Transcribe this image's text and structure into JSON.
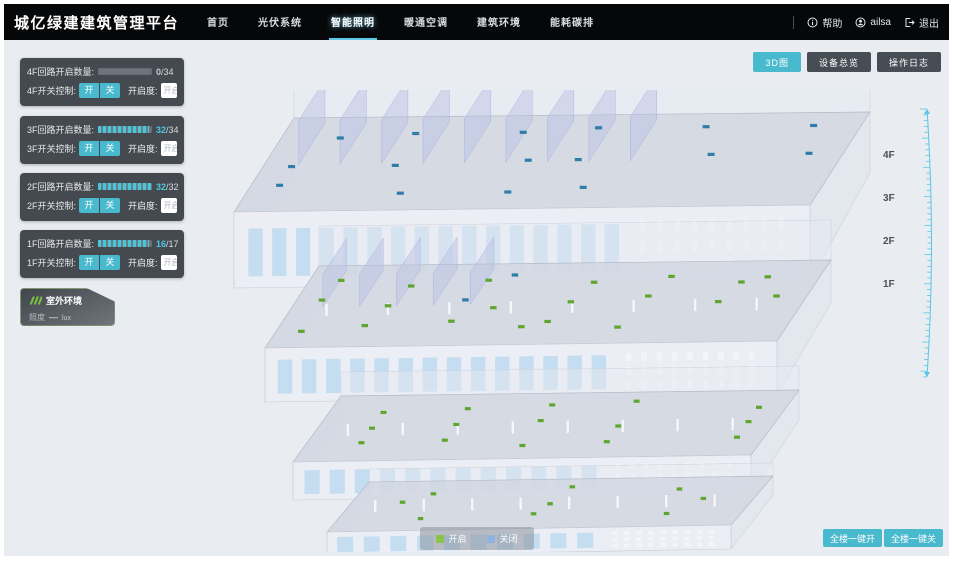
{
  "accent": {
    "teal": "#49b9cd",
    "cyan": "#4cc8e0"
  },
  "header": {
    "title": "城亿绿建建筑管理平台",
    "nav": [
      {
        "label": "首页"
      },
      {
        "label": "光伏系统"
      },
      {
        "label": "智能照明"
      },
      {
        "label": "暖通空调"
      },
      {
        "label": "建筑环境"
      },
      {
        "label": "能耗碳排"
      }
    ],
    "help_label": "帮助",
    "username": "ailsa",
    "logout_label": "退出"
  },
  "view_buttons": [
    {
      "label": "3D图"
    },
    {
      "label": "设备总览"
    },
    {
      "label": "操作日志"
    }
  ],
  "floor_panels": [
    {
      "circuit_label": "4F回路开启数量:",
      "open_count": "0",
      "total_count": "/34",
      "progress_width": "0%",
      "count_color": "#c3c8ce",
      "switch_label": "4F开关控制:",
      "on_label": "开",
      "off_label": "关",
      "dim_label": "开启度:",
      "dim_placeholder": "开启度",
      "percent_label": "%"
    },
    {
      "circuit_label": "3F回路开启数量:",
      "open_count": "32",
      "total_count": "/34",
      "progress_width": "94%",
      "count_color": "#4cc8e0",
      "switch_label": "3F开关控制:",
      "on_label": "开",
      "off_label": "关",
      "dim_label": "开启度:",
      "dim_placeholder": "开启度",
      "percent_label": "%"
    },
    {
      "circuit_label": "2F回路开启数量:",
      "open_count": "32",
      "total_count": "/32",
      "progress_width": "100%",
      "count_color": "#4cc8e0",
      "switch_label": "2F开关控制:",
      "on_label": "开",
      "off_label": "关",
      "dim_label": "开启度:",
      "dim_placeholder": "开启度",
      "percent_label": "%"
    },
    {
      "circuit_label": "1F回路开启数量:",
      "open_count": "16",
      "total_count": "/17",
      "progress_width": "94%",
      "count_color": "#4cc8e0",
      "switch_label": "1F开关控制:",
      "on_label": "开",
      "off_label": "关",
      "dim_label": "开启度:",
      "dim_placeholder": "开启度",
      "percent_label": "%"
    }
  ],
  "outdoor_panel": {
    "title": "室外环境",
    "metric_label": "照度",
    "metric_value": "—",
    "metric_unit": "lux"
  },
  "floor_axis_labels": [
    "4F",
    "3F",
    "2F",
    "1F"
  ],
  "legend": {
    "on_label": "开启",
    "on_color": "#8bc34a",
    "off_label": "关闭",
    "off_color": "#8fb3e0"
  },
  "bulk_buttons": [
    {
      "label": "全楼一键开"
    },
    {
      "label": "全楼一键关"
    }
  ],
  "building": {
    "floors": [
      {
        "name": "4F",
        "on_markers": 0,
        "off_markers": 16
      },
      {
        "name": "3F",
        "on_markers": 20,
        "off_markers": 2
      },
      {
        "name": "2F",
        "on_markers": 15,
        "off_markers": 0
      },
      {
        "name": "1F",
        "on_markers": 9,
        "off_markers": 0
      }
    ],
    "on_color": "#5fa52f",
    "off_color": "#2f7da8"
  }
}
